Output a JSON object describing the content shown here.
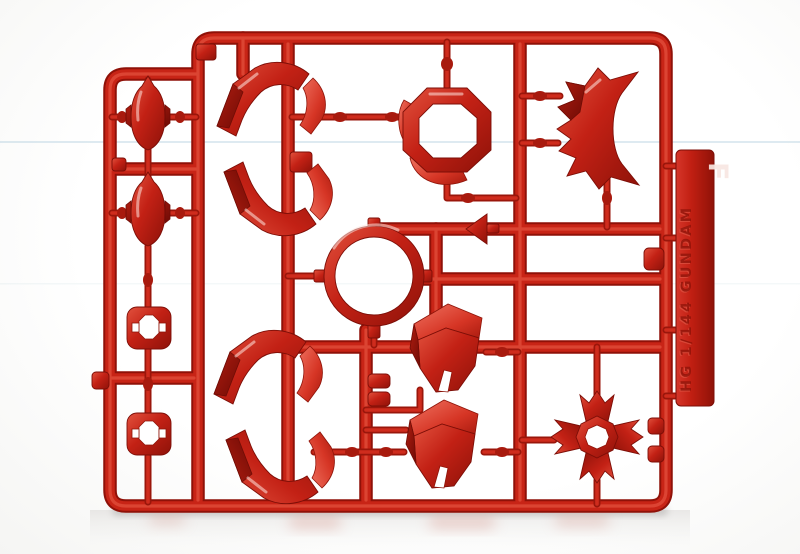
{
  "scene": {
    "type": "product-photo",
    "subject": "Red plastic model-kit parts runner (sprue) photographed on a seamless white background",
    "background_color": "#fdfdfd",
    "floor_shadow_color": "#b9b4b2"
  },
  "runner": {
    "letter": "F",
    "embossed_text": "HG 1/144 GUNDAM",
    "plastic_color": "#c82416",
    "plastic_dark": "#8f1108",
    "plastic_highlight": "#df4a38"
  },
  "parts_visible": {
    "capsule_pods": 2,
    "socket_plates_with_holes": 2,
    "curved_armor_pieces": 4,
    "center_ring": 1,
    "octagonal_collar_ring": 1,
    "spiked_crest": 1,
    "arrow_clip": 1,
    "chest_armor_blocks": 2,
    "cross_thruster": 1
  }
}
